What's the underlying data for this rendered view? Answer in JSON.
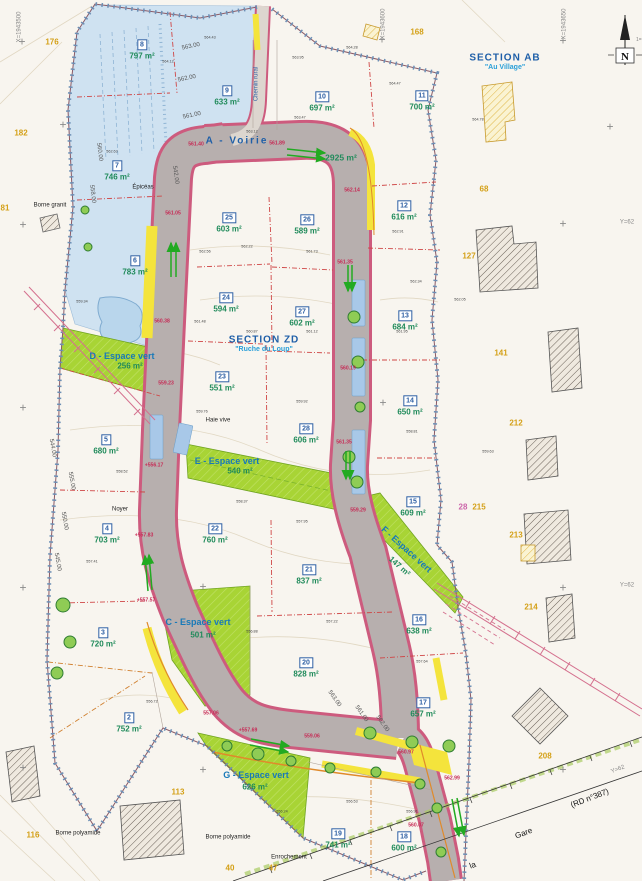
{
  "map": {
    "north": {
      "label": "N",
      "scale_note": "1=52"
    },
    "sections": [
      {
        "name": "SECTION AB",
        "subtitle": "\"Au Village\"",
        "x": 505,
        "y": 58
      },
      {
        "name": "SECTION ZD",
        "subtitle": "\"Ruche du Loup\"",
        "x": 264,
        "y": 340
      }
    ],
    "road": {
      "label": "A - Voirie",
      "area": "2925 m²",
      "lx": 237,
      "ly": 141,
      "ax": 341,
      "ay": 158
    },
    "lots": [
      {
        "n": "2",
        "a": "752 m²",
        "x": 129,
        "y": 714
      },
      {
        "n": "3",
        "a": "720 m²",
        "x": 103,
        "y": 629
      },
      {
        "n": "4",
        "a": "703 m²",
        "x": 107,
        "y": 525
      },
      {
        "n": "5",
        "a": "680 m²",
        "x": 106,
        "y": 436
      },
      {
        "n": "6",
        "a": "783 m²",
        "x": 135,
        "y": 257
      },
      {
        "n": "7",
        "a": "746 m²",
        "x": 117,
        "y": 162
      },
      {
        "n": "8",
        "a": "797 m²",
        "x": 142,
        "y": 41
      },
      {
        "n": "9",
        "a": "633 m²",
        "x": 227,
        "y": 87
      },
      {
        "n": "10",
        "a": "697 m²",
        "x": 322,
        "y": 93
      },
      {
        "n": "11",
        "a": "700 m²",
        "x": 422,
        "y": 92
      },
      {
        "n": "12",
        "a": "616 m²",
        "x": 404,
        "y": 202
      },
      {
        "n": "13",
        "a": "684 m²",
        "x": 405,
        "y": 312
      },
      {
        "n": "14",
        "a": "650 m²",
        "x": 410,
        "y": 397
      },
      {
        "n": "15",
        "a": "609 m²",
        "x": 413,
        "y": 498
      },
      {
        "n": "16",
        "a": "638 m²",
        "x": 419,
        "y": 616
      },
      {
        "n": "17",
        "a": "657 m²",
        "x": 423,
        "y": 699
      },
      {
        "n": "18",
        "a": "600 m²",
        "x": 404,
        "y": 833
      },
      {
        "n": "19",
        "a": "741 m²",
        "x": 338,
        "y": 830
      },
      {
        "n": "20",
        "a": "828 m²",
        "x": 306,
        "y": 659
      },
      {
        "n": "21",
        "a": "837 m²",
        "x": 309,
        "y": 566
      },
      {
        "n": "22",
        "a": "760 m²",
        "x": 215,
        "y": 525
      },
      {
        "n": "23",
        "a": "551 m²",
        "x": 222,
        "y": 373
      },
      {
        "n": "24",
        "a": "594 m²",
        "x": 226,
        "y": 294
      },
      {
        "n": "25",
        "a": "603 m²",
        "x": 229,
        "y": 214
      },
      {
        "n": "26",
        "a": "589 m²",
        "x": 307,
        "y": 216
      },
      {
        "n": "27",
        "a": "602 m²",
        "x": 302,
        "y": 308
      },
      {
        "n": "28",
        "a": "606 m²",
        "x": 306,
        "y": 425
      }
    ],
    "green_spaces": [
      {
        "label": "C - Espace vert",
        "area": "501 m²",
        "lx": 198,
        "ly": 623,
        "ax": 203,
        "ay": 636,
        "rot": 0
      },
      {
        "label": "D - Espace vert",
        "area": "256 m²",
        "lx": 122,
        "ly": 357,
        "ax": 130,
        "ay": 367,
        "rot": 0
      },
      {
        "label": "E - Espace vert",
        "area": "540 m²",
        "lx": 227,
        "ly": 462,
        "ax": 240,
        "ay": 472,
        "rot": 0
      },
      {
        "label": "F - Espace vert",
        "area": "147 m²",
        "lx": 406,
        "ly": 550,
        "ax": 399,
        "ay": 567,
        "rot": 42
      },
      {
        "label": "G - Espace vert",
        "area": "626 m²",
        "lx": 256,
        "ly": 776,
        "ax": 255,
        "ay": 788,
        "rot": 0
      }
    ],
    "parcels": [
      [
        52,
        43,
        "176"
      ],
      [
        21,
        134,
        "182"
      ],
      [
        5,
        209,
        "81"
      ],
      [
        417,
        33,
        "168"
      ],
      [
        484,
        190,
        "68"
      ],
      [
        469,
        257,
        "127"
      ],
      [
        501,
        354,
        "141"
      ],
      [
        516,
        424,
        "212"
      ],
      [
        479,
        508,
        "215"
      ],
      [
        463,
        508,
        "28",
        "pink"
      ],
      [
        516,
        536,
        "213"
      ],
      [
        531,
        608,
        "214"
      ],
      [
        545,
        757,
        "208"
      ],
      [
        178,
        793,
        "113"
      ],
      [
        33,
        836,
        "116"
      ],
      [
        230,
        869,
        "40"
      ],
      [
        273,
        869,
        "47"
      ]
    ],
    "elevations": [
      [
        196,
        145,
        "561.40"
      ],
      [
        277,
        144,
        "561.89"
      ],
      [
        352,
        191,
        "562.14"
      ],
      [
        173,
        214,
        "561.05"
      ],
      [
        162,
        322,
        "560.38"
      ],
      [
        166,
        384,
        "559.23"
      ],
      [
        348,
        369,
        "560.19"
      ],
      [
        154,
        466,
        "+556.17"
      ],
      [
        345,
        263,
        "561.35"
      ],
      [
        344,
        443,
        "561.35"
      ],
      [
        358,
        511,
        "559.29"
      ],
      [
        144,
        536,
        "+557.83"
      ],
      [
        146,
        601,
        "+557.57"
      ],
      [
        211,
        714,
        "557.06"
      ],
      [
        248,
        731,
        "+557.69"
      ],
      [
        312,
        737,
        "559.06"
      ],
      [
        406,
        753,
        "560.97"
      ],
      [
        452,
        779,
        "562.99"
      ],
      [
        416,
        826,
        "560.07"
      ]
    ],
    "spot_heights": [
      [
        168,
        62,
        "564.12"
      ],
      [
        210,
        38,
        "564.43"
      ],
      [
        298,
        58,
        "563.95"
      ],
      [
        352,
        48,
        "564.28"
      ],
      [
        395,
        84,
        "564.47"
      ],
      [
        300,
        118,
        "563.47"
      ],
      [
        252,
        132,
        "563.12"
      ],
      [
        205,
        252,
        "562.56"
      ],
      [
        247,
        247,
        "562.22"
      ],
      [
        312,
        252,
        "561.73"
      ],
      [
        398,
        232,
        "562.91"
      ],
      [
        416,
        282,
        "562.34"
      ],
      [
        200,
        322,
        "561.48"
      ],
      [
        252,
        332,
        "560.87"
      ],
      [
        312,
        332,
        "561.12"
      ],
      [
        402,
        332,
        "561.95"
      ],
      [
        202,
        412,
        "559.76"
      ],
      [
        302,
        402,
        "559.92"
      ],
      [
        412,
        432,
        "558.81"
      ],
      [
        242,
        502,
        "558.37"
      ],
      [
        302,
        522,
        "557.95"
      ],
      [
        122,
        472,
        "558.52"
      ],
      [
        92,
        562,
        "557.41"
      ],
      [
        252,
        632,
        "556.88"
      ],
      [
        332,
        622,
        "557.22"
      ],
      [
        422,
        662,
        "557.64"
      ],
      [
        352,
        802,
        "556.53"
      ],
      [
        412,
        812,
        "556.91"
      ],
      [
        282,
        812,
        "556.24"
      ],
      [
        152,
        702,
        "556.72"
      ],
      [
        82,
        302,
        "559.34"
      ],
      [
        112,
        152,
        "562.63"
      ],
      [
        478,
        120,
        "564.78"
      ],
      [
        460,
        300,
        "562.05"
      ],
      [
        488,
        452,
        "559.63"
      ]
    ],
    "contour_labels": [
      [
        191,
        47,
        -12,
        "563.00"
      ],
      [
        187,
        79,
        -12,
        "562.00"
      ],
      [
        192,
        116,
        -12,
        "561.00"
      ],
      [
        99,
        152,
        83,
        "560.00"
      ],
      [
        92,
        194,
        83,
        "558.00"
      ],
      [
        52,
        448,
        80,
        "544.00"
      ],
      [
        71,
        481,
        80,
        "555.00"
      ],
      [
        64,
        521,
        80,
        "550.00"
      ],
      [
        57,
        562,
        80,
        "545.00"
      ],
      [
        175,
        175,
        82,
        "542.00"
      ],
      [
        334,
        699,
        55,
        "563.00"
      ],
      [
        361,
        714,
        55,
        "561.00"
      ],
      [
        382,
        724,
        55,
        "562.00"
      ]
    ],
    "coord_labels": [
      [
        20,
        27,
        -90,
        "X=1943500"
      ],
      [
        384,
        24,
        -90,
        "X=1943600"
      ],
      [
        565,
        24,
        -90,
        "X=1943650"
      ],
      [
        627,
        223,
        0,
        "Y=62"
      ],
      [
        627,
        586,
        0,
        "Y=62"
      ],
      [
        618,
        770,
        -20,
        "Y=62"
      ]
    ],
    "notes": [
      [
        143,
        188,
        0,
        "Épicéas",
        ""
      ],
      [
        218,
        421,
        0,
        "Haie vive",
        ""
      ],
      [
        120,
        510,
        0,
        "Noyer",
        ""
      ],
      [
        289,
        858,
        0,
        "Enrochement",
        ""
      ],
      [
        50,
        206,
        0,
        "Borne granit",
        ""
      ],
      [
        78,
        834,
        0,
        "Borne polyamide",
        ""
      ],
      [
        228,
        838,
        0,
        "Borne polyamide",
        ""
      ],
      [
        473,
        866,
        -21,
        "la",
        "big"
      ],
      [
        524,
        834,
        -21,
        "Gare",
        "big"
      ],
      [
        590,
        799,
        -21,
        "(RD n°387)",
        "big"
      ],
      [
        257,
        84,
        -90,
        "Chemin rural",
        "blue"
      ]
    ],
    "grid_crosses": [
      [
        22,
        42
      ],
      [
        382,
        40
      ],
      [
        563,
        41
      ],
      [
        63,
        125
      ],
      [
        610,
        127
      ],
      [
        23,
        225
      ],
      [
        563,
        224
      ],
      [
        23,
        408
      ],
      [
        383,
        403
      ],
      [
        23,
        588
      ],
      [
        203,
        587
      ],
      [
        563,
        588
      ],
      [
        23,
        768
      ],
      [
        203,
        770
      ],
      [
        563,
        770
      ]
    ],
    "colors": {
      "paper": "#f8f5ef",
      "road_gray": "#b7afae",
      "road_edge": "#cd5b7e",
      "green_space": "#a8d435",
      "blue_zone": "#cfe2f1",
      "yellow_strip": "#f4e43c",
      "lot_number_blue": "#2e5fa3",
      "area_green": "#1f8a5a",
      "parcel_orange": "#d4a017",
      "elevation_red": "#c62a55",
      "boundary_tick": "#6c8fb5"
    }
  }
}
